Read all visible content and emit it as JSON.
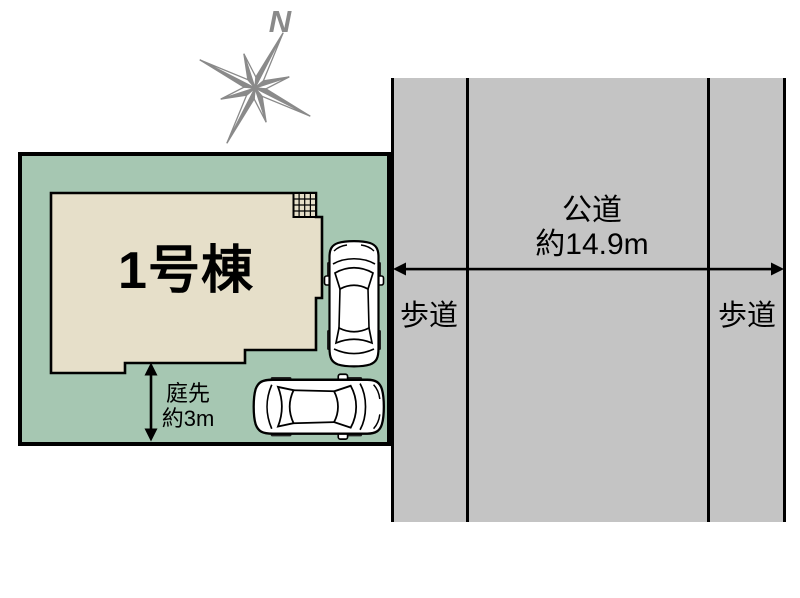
{
  "colors": {
    "plot_green": "#a6c7b2",
    "building_beige": "#e6dfc9",
    "road_gray": "#c4c4c4",
    "line_black": "#000000",
    "compass_gray": "#8a8a8a",
    "car_white": "#ffffff"
  },
  "compass": {
    "north_label": "N",
    "icon": "compass-rose-icon"
  },
  "site": {
    "building": {
      "label": "1号棟"
    },
    "garden": {
      "label": "庭先",
      "depth": "約3m"
    },
    "balcony_icon": "balcony-grid-icon",
    "car_icons": [
      "car-top-view-icon",
      "car-top-view-icon"
    ]
  },
  "road": {
    "label": "公道",
    "width": "約14.9m",
    "sidewalk_left": "歩道",
    "sidewalk_right": "歩道"
  }
}
